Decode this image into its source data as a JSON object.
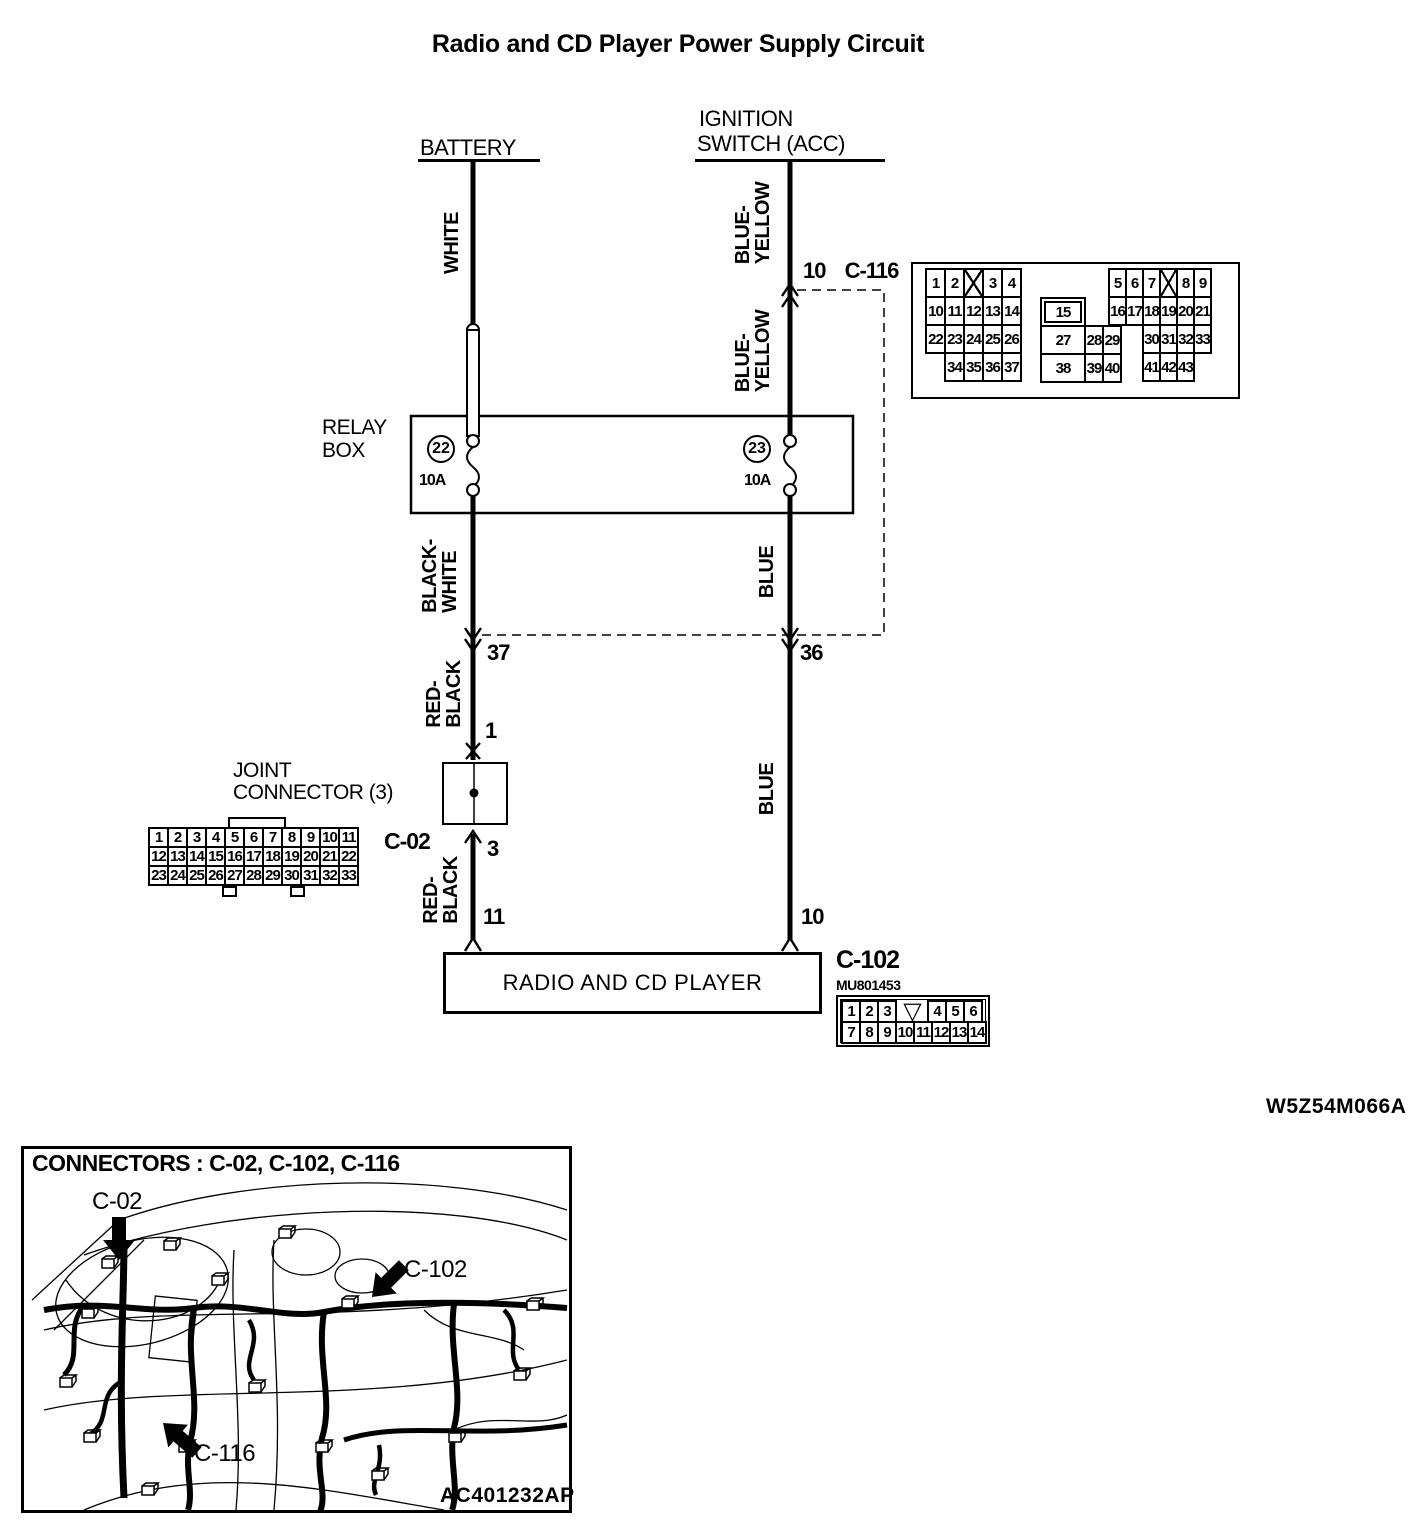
{
  "title": "Radio and CD Player Power Supply Circuit",
  "diagram_code": "W5Z54M066A",
  "components": {
    "battery": "BATTERY",
    "ignition_line1": "IGNITION",
    "ignition_line2": "SWITCH (ACC)",
    "relay_line1": "RELAY",
    "relay_line2": "BOX",
    "joint_line1": "JOINT",
    "joint_line2": "CONNECTOR (3)",
    "radio": "RADIO AND CD PLAYER"
  },
  "wire_labels": {
    "white": "WHITE",
    "blue_yellow_upper": [
      "BLUE-",
      "YELLOW"
    ],
    "blue_yellow_lower": [
      "BLUE-",
      "YELLOW"
    ],
    "black_white": [
      "BLACK-",
      "WHITE"
    ],
    "blue_upper": "BLUE",
    "red_black_upper": [
      "RED-",
      "BLACK"
    ],
    "blue_lower": "BLUE",
    "red_black_lower": [
      "RED-",
      "BLACK"
    ]
  },
  "fuses": [
    {
      "number": "22",
      "rating": "10A"
    },
    {
      "number": "23",
      "rating": "10A"
    }
  ],
  "pins": {
    "ignition_c116": "10",
    "left_c116": "37",
    "right_c116": "36",
    "joint_in": "1",
    "joint_out": "3",
    "radio_left": "11",
    "radio_right": "10"
  },
  "connectors": {
    "c116": {
      "name": "C-116",
      "left_rows": [
        [
          "1",
          "2",
          {
            "t": "",
            "style": "x"
          },
          "3",
          "4"
        ],
        [
          "10",
          "11",
          "12",
          "13",
          "14"
        ],
        [
          "22",
          "23",
          "24",
          "25",
          "26"
        ],
        [
          {
            "t": "",
            "style": "empty"
          },
          "34",
          "35",
          "36",
          "37"
        ]
      ],
      "mid_rows": [
        [
          {
            "t": "15",
            "style": "dbl wide"
          },
          {
            "t": "",
            "style": "empty"
          },
          {
            "t": "",
            "style": "empty"
          }
        ],
        [
          {
            "t": "27",
            "style": "wide"
          },
          "28",
          "29"
        ],
        [
          {
            "t": "38",
            "style": "wide"
          },
          "39",
          "40"
        ]
      ],
      "right_rows": [
        [
          "5",
          "6",
          "7",
          {
            "t": "",
            "style": "x"
          },
          "8",
          "9"
        ],
        [
          "16",
          "17",
          "18",
          "19",
          "20",
          "21"
        ],
        [
          {
            "t": "",
            "style": "empty"
          },
          {
            "t": "",
            "style": "empty"
          },
          "30",
          "31",
          "32",
          "33"
        ],
        [
          {
            "t": "",
            "style": "empty"
          },
          {
            "t": "",
            "style": "empty"
          },
          "41",
          "42",
          "43",
          {
            "t": "",
            "style": "empty"
          }
        ]
      ]
    },
    "c02": {
      "name": "C-02",
      "rows": [
        [
          "1",
          "2",
          "3",
          "4",
          "5",
          "6",
          "7",
          "8",
          "9",
          "10",
          "11"
        ],
        [
          "12",
          "13",
          "14",
          "15",
          "16",
          "17",
          "18",
          "19",
          "20",
          "21",
          "22"
        ],
        [
          "23",
          "24",
          "25",
          "26",
          "27",
          "28",
          "29",
          "30",
          "31",
          "32",
          "33"
        ]
      ]
    },
    "c102": {
      "name": "C-102",
      "part_no": "MU801453",
      "rows": [
        [
          "1",
          "2",
          "3",
          {
            "t": "",
            "style": "vc"
          },
          "4",
          "5",
          "6"
        ],
        [
          "7",
          "8",
          "9",
          "10",
          "11",
          "12",
          "13",
          "14"
        ]
      ]
    }
  },
  "inset": {
    "heading": "CONNECTORS : C-02, C-102, C-116",
    "c02_label": "C-02",
    "c102_label": "C-102",
    "c116_label": "C-116",
    "image_code": "AC401232AP"
  }
}
